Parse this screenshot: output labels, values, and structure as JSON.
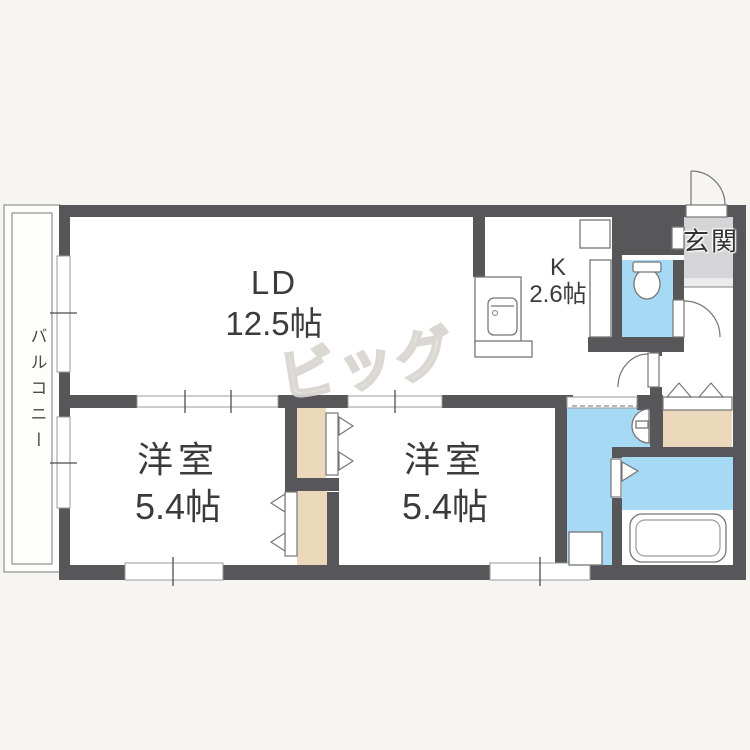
{
  "plan": {
    "watermark": "ビッグ",
    "rooms": {
      "living_dining": {
        "label": "LD",
        "size": "12.5帖"
      },
      "kitchen": {
        "label": "K",
        "size": "2.6帖"
      },
      "entrance": {
        "label": "玄関"
      },
      "bedroom_west": {
        "label": "洋室",
        "size": "5.4帖"
      },
      "bedroom_east": {
        "label": "洋室",
        "size": "5.4帖"
      },
      "balcony": {
        "label": "バルコニー"
      }
    },
    "colors": {
      "wall": "#57575a",
      "water_rooms": "#a6d9f3",
      "closet_floor": "#ebd8ba",
      "entrance_floor": "#d5d5d7",
      "room_floor": "#ffffff",
      "background": "#f6f5f2"
    },
    "fixtures": [
      "kitchen-sink-counter",
      "refrigerator-space",
      "toilet",
      "washbasin",
      "bathtub",
      "washing-machine-pan",
      "shoe-cabinet"
    ]
  }
}
